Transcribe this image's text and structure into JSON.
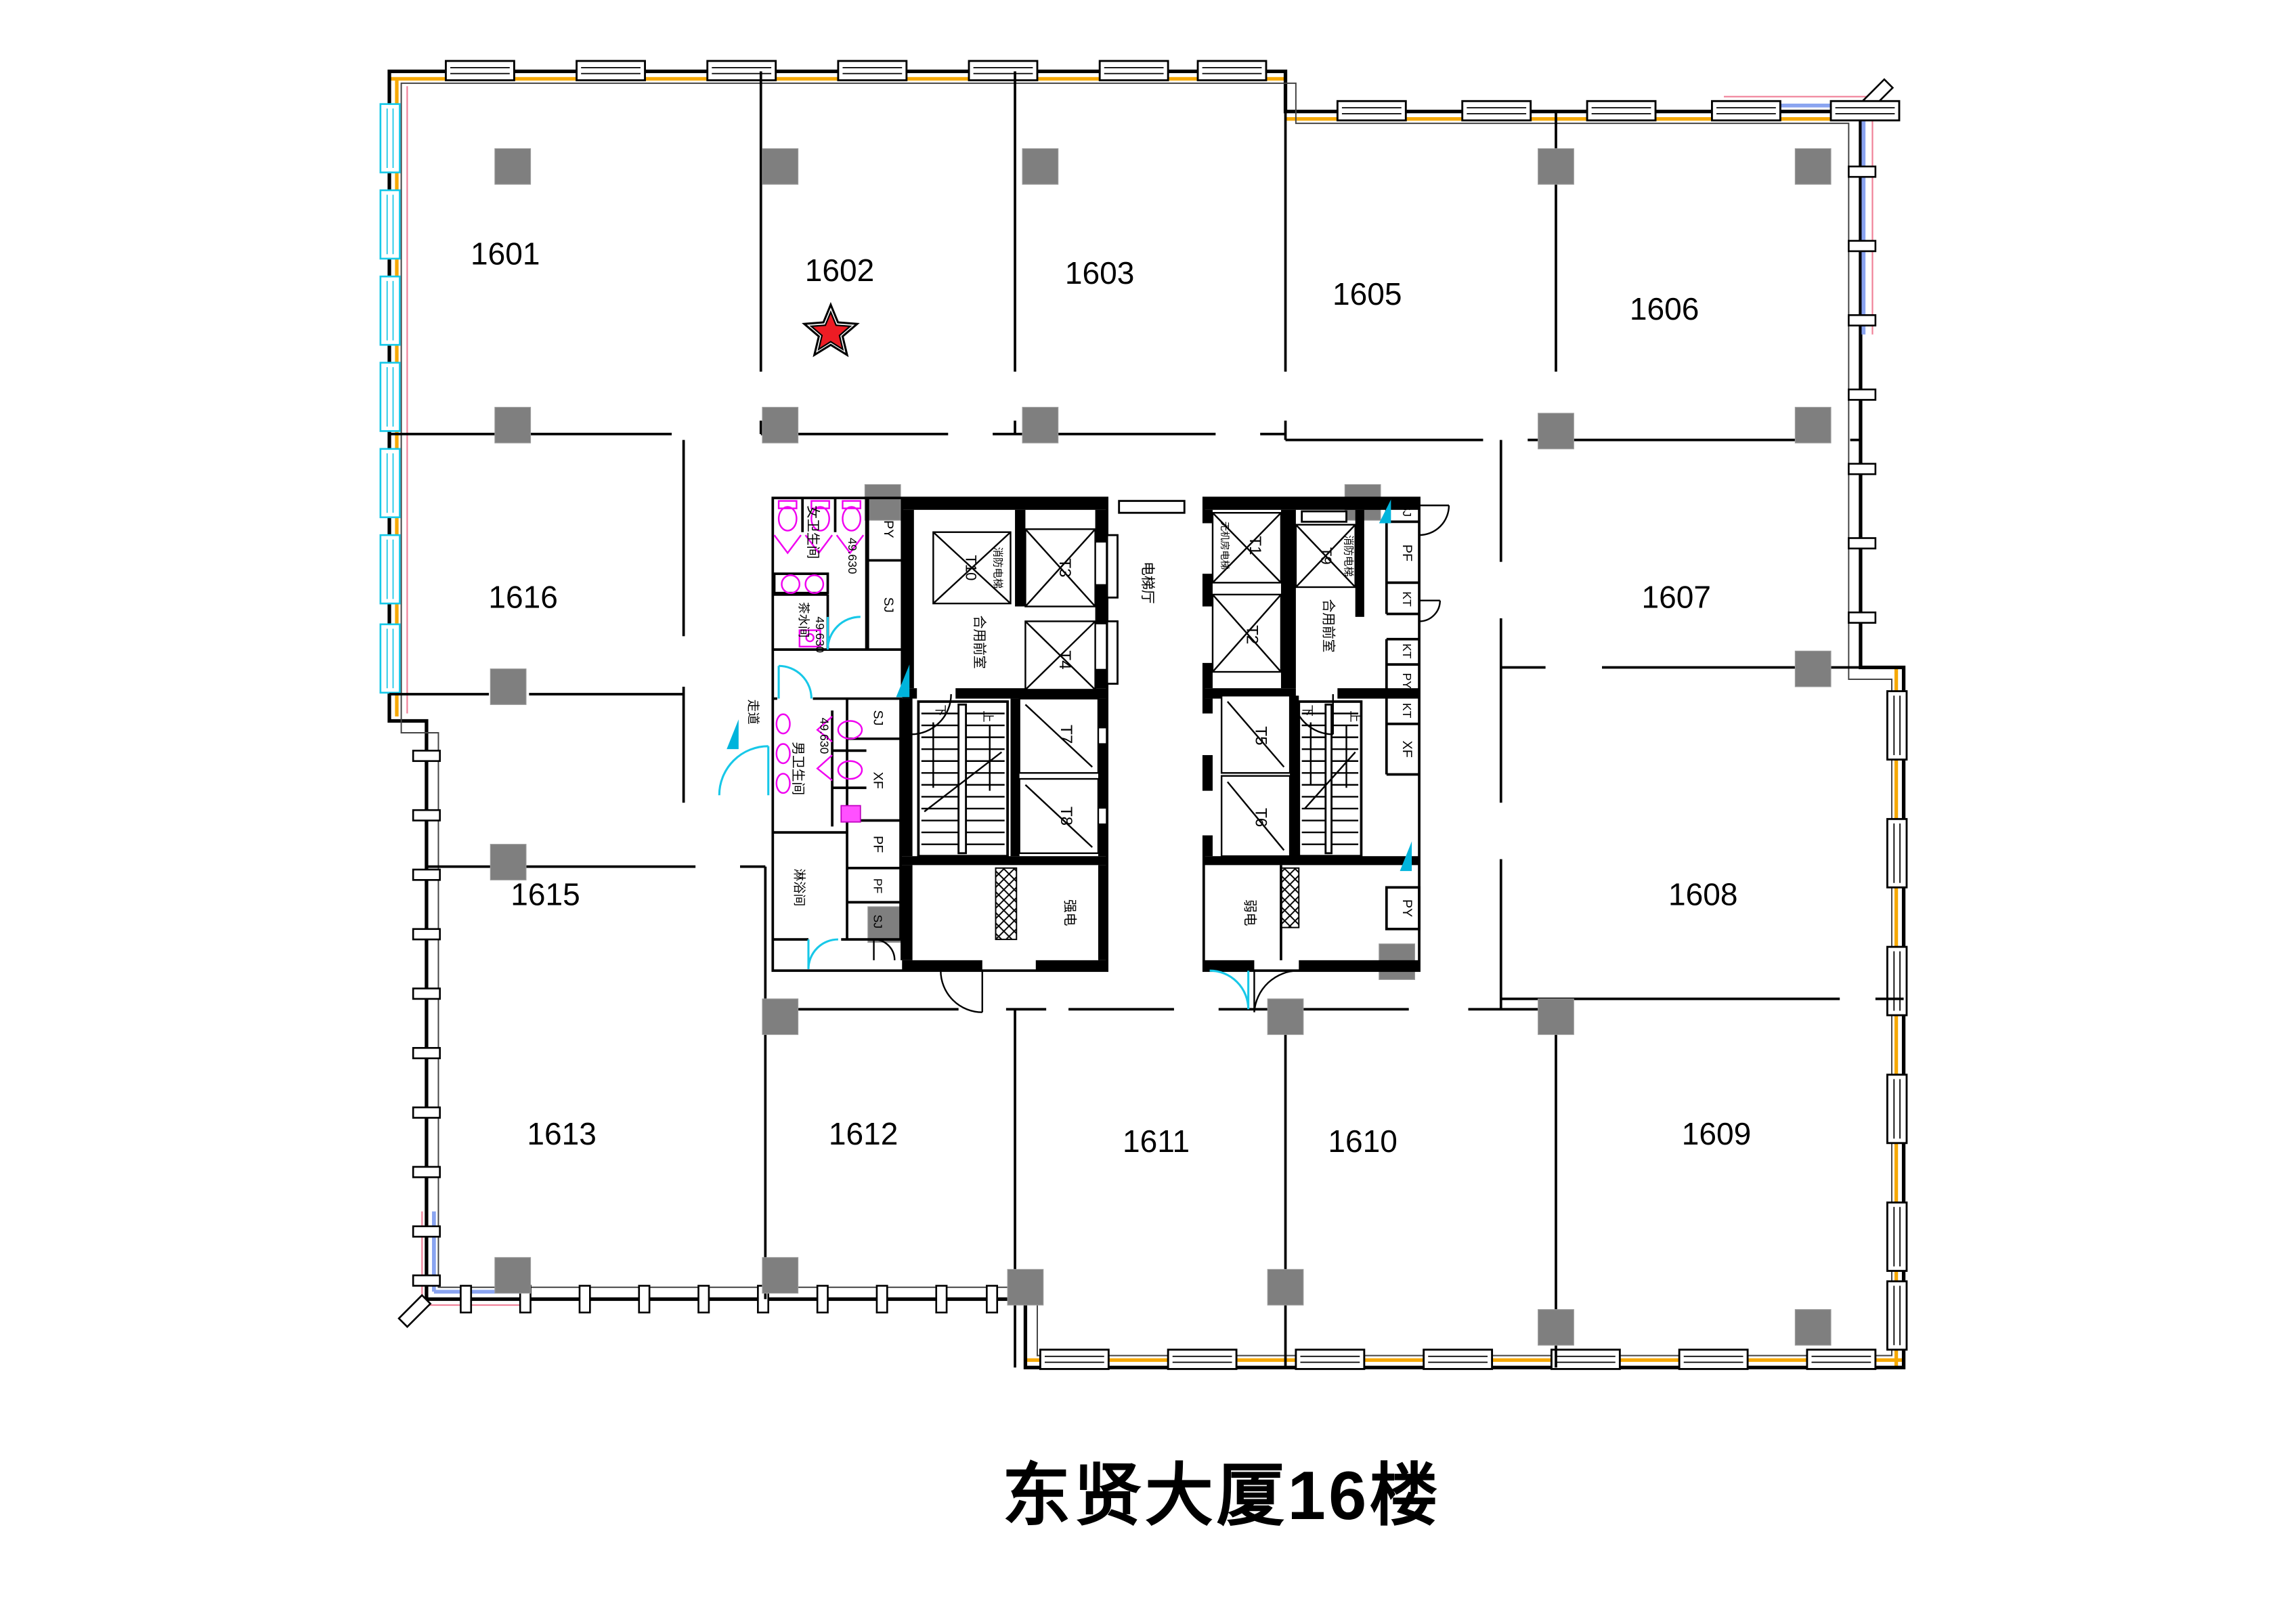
{
  "title": "东贤大厦16楼",
  "marker": {
    "room": "1602",
    "shape": "star",
    "color": "#ed1c24"
  },
  "rooms": {
    "1601": "1601",
    "1602": "1602",
    "1603": "1603",
    "1605": "1605",
    "1606": "1606",
    "1607": "1607",
    "1608": "1608",
    "1609": "1609",
    "1610": "1610",
    "1611": "1611",
    "1612": "1612",
    "1613": "1613",
    "1615": "1615",
    "1616": "1616"
  },
  "hall": {
    "label": "电梯厅"
  },
  "core_left": {
    "womens_wc": "女卫生间",
    "mens_wc": "男卫生间",
    "pantry": "茶水间",
    "shower": "淋浴间",
    "corridor": "走道",
    "vestibule": "合用前室",
    "fire_elevator": "消防电梯",
    "strong_electric": "强电",
    "levels": {
      "womens": "49.630",
      "pantry": "49.630",
      "mens": "49.630"
    },
    "elevators": {
      "t10": "T10",
      "t3": "T3",
      "t4": "T4",
      "t7": "T7",
      "t8": "T8"
    },
    "shafts": {
      "py": "PY",
      "sj": "SJ",
      "sj2": "SJ",
      "xf": "XF",
      "pf": "PF",
      "pf2": "PF",
      "sj3": "SJ"
    },
    "stairs": {
      "up": "上",
      "down": "下"
    }
  },
  "core_right": {
    "mrl_elevator": "无机房电梯",
    "fire_elevator": "消防电梯",
    "vestibule": "合用前室",
    "weak_electric": "弱电",
    "elevators": {
      "t1": "T1",
      "t2": "T2",
      "t9": "T9",
      "t5": "T5",
      "t6": "T6"
    },
    "shafts": {
      "sj": "SJ",
      "pf": "PF",
      "kt": "KT",
      "kt2": "KT",
      "py": "PY",
      "kt3": "KT",
      "xf": "XF",
      "py2": "PY"
    },
    "stairs": {
      "up": "上",
      "down": "下"
    }
  },
  "colors": {
    "wall": "#000000",
    "column_gray": "#7f7f7f",
    "window_orange": "#f6a800",
    "glass_cyan": "#17c8e8",
    "fixture_magenta": "#ff00ff",
    "guide_blue": "#8aa4f0",
    "guide_pink": "#f08098",
    "star_red": "#ed1c24"
  }
}
